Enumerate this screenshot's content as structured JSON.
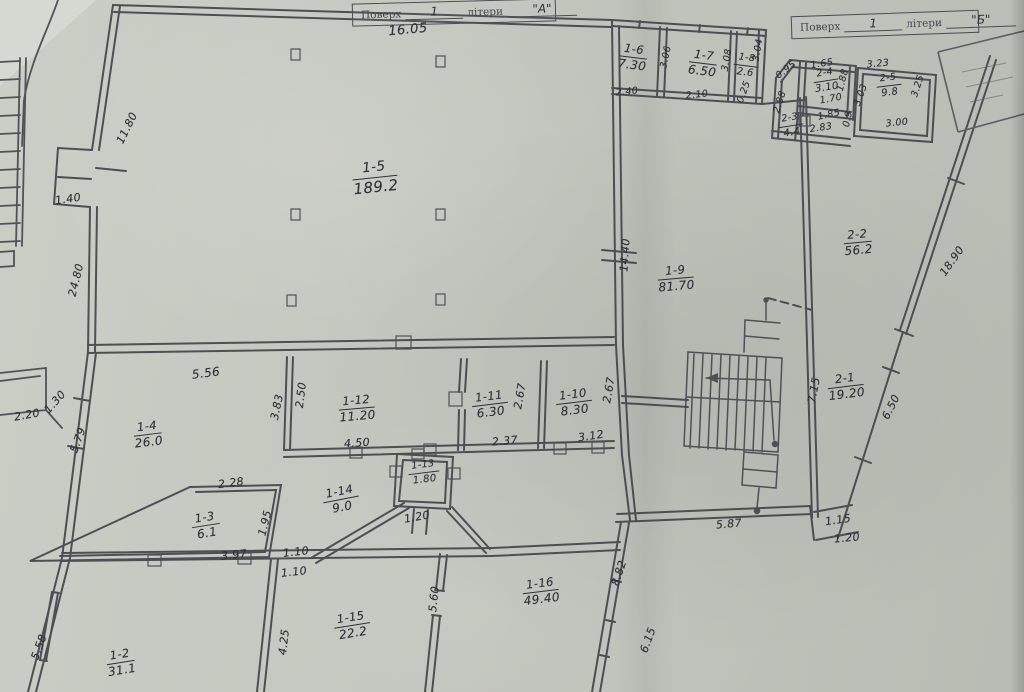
{
  "titles": {
    "a": {
      "floor_label": "Поверх",
      "floor": "1",
      "letters_label": "літери",
      "letters": "\"А\""
    },
    "b": {
      "floor_label": "Поверх",
      "floor": "1",
      "letters_label": "літери",
      "letters": "\"Б\""
    }
  },
  "rooms": {
    "r1_2": {
      "id": "1-2",
      "area": "31.1"
    },
    "r1_3": {
      "id": "1-3",
      "area": "6.1"
    },
    "r1_4": {
      "id": "1-4",
      "area": "26.0"
    },
    "r1_5": {
      "id": "1-5",
      "area": "189.2"
    },
    "r1_6": {
      "id": "1-6",
      "area": "7.30"
    },
    "r1_7": {
      "id": "1-7",
      "area": "6.50"
    },
    "r1_8": {
      "id": "1-8",
      "area": "2.6"
    },
    "r1_9": {
      "id": "1-9",
      "area": "81.70"
    },
    "r1_10": {
      "id": "1-10",
      "area": "8.30"
    },
    "r1_11": {
      "id": "1-11",
      "area": "6.30"
    },
    "r1_12": {
      "id": "1-12",
      "area": "11.20"
    },
    "r1_13": {
      "id": "1-13",
      "area": "1.80"
    },
    "r1_14": {
      "id": "1-14",
      "area": "9.0"
    },
    "r1_15": {
      "id": "1-15",
      "area": "22.2"
    },
    "r1_16": {
      "id": "1-16",
      "area": "49.40"
    },
    "r2_1": {
      "id": "2-1",
      "area": "19.20"
    },
    "r2_2": {
      "id": "2-2",
      "area": "56.2"
    },
    "r2_3": {
      "id": "2-3",
      "area": "4.4"
    },
    "r2_4": {
      "id": "2-4",
      "area": "3.10"
    },
    "r2_5": {
      "id": "2-5",
      "area": "9.8"
    }
  },
  "dims": {
    "top_16_05": "16.05",
    "left_11_80": "11.80",
    "window_1_40": "1.40",
    "left_24_80": "24.80",
    "annex_2_20": "2.20",
    "annex_1_30": "1.30",
    "w1_4_left": "5.79",
    "w1_4_top": "5.56",
    "w1_4_right": "3.83",
    "w1_12_left": "2.50",
    "w1_12_bottom": "4.50",
    "w1_11_right": "2.67",
    "w1_11_bottom": "2.37",
    "w1_10_right": "2.67",
    "w1_10_bottom": "3.12",
    "w1_3_top": "2.28",
    "w1_3_right": "1.95",
    "w1_3_bottom": "3.97",
    "door_a": "1.10",
    "door_b": "1.10",
    "w1_13_bottom": "1.20",
    "w1_2_left": "5.58",
    "w1_2_right": "4.25",
    "w1_15_right": "5.60",
    "w1_16_right": "8.82",
    "w1_16_corner": "6.15",
    "w1_9_bottom": "5.87",
    "jog_1_15": "1.15",
    "jog_1_20": "1.20",
    "w1_9_left": "14.40",
    "w2_1_left": "7.15",
    "w2_1_diag": "6.50",
    "b_diag": "18.90",
    "w1_6_right": "3.06",
    "w1_6_bottom": "2.40",
    "w1_7_right": "3.08",
    "w1_7_bottom": "2.10",
    "w1_8_right": "3.04",
    "w1_8_bottom": "0.25",
    "b_slant": "0.95",
    "w2_3_left": "2.88",
    "w2_4_top": "1.65",
    "w2_4_right": "1.88",
    "w2_4_bottom": "1.70",
    "w2_3_inner": "1.85",
    "w2_3_tick": "0.9",
    "w2_3_bottom": "2.83",
    "w2_5_top": "3.23",
    "w2_5_left": "3.03",
    "w2_5_right": "3.25",
    "w2_5_bottom": "3.00"
  }
}
